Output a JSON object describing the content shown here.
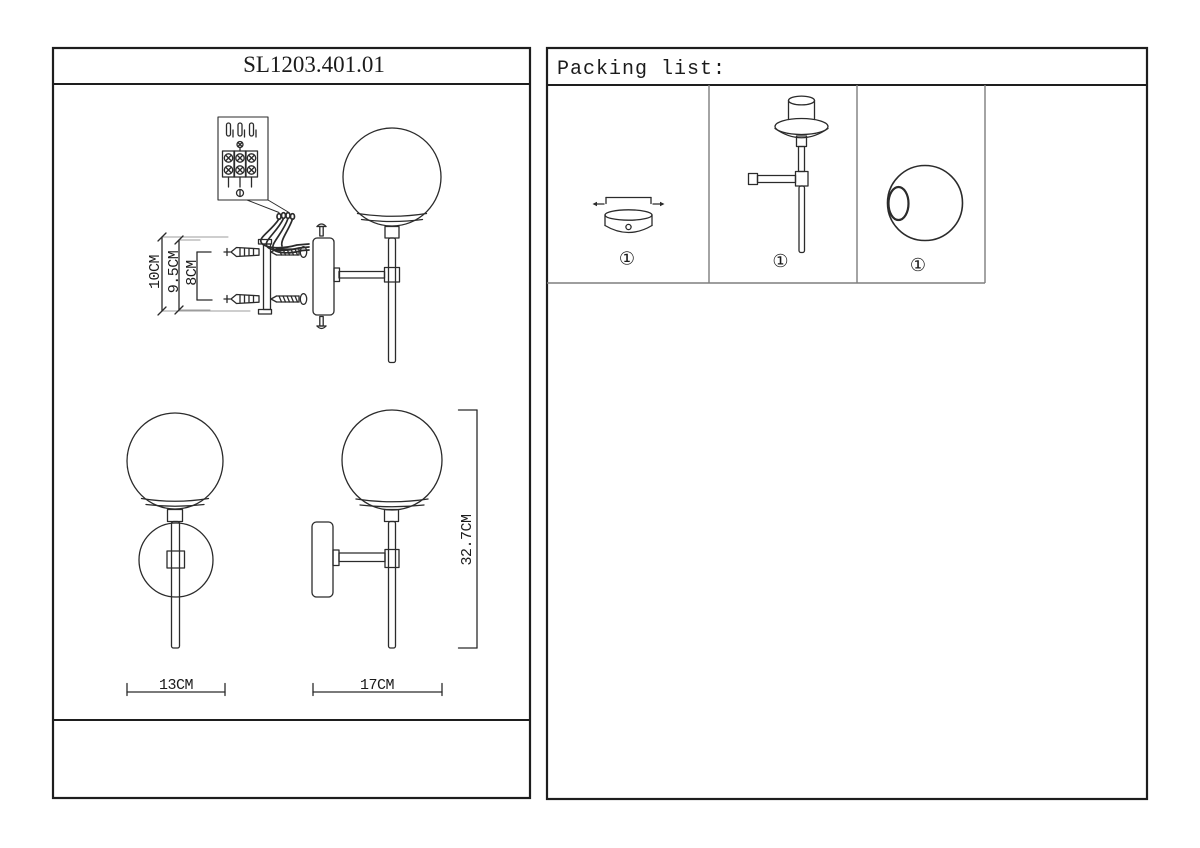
{
  "colors": {
    "background": "#ffffff",
    "ink": "#2b2b2b",
    "frame": "#1e1e1e",
    "grid_line": "#7e7e7e",
    "extension_line": "#9c9c9c"
  },
  "left_panel": {
    "title": "SL1203.401.01",
    "installation": {
      "dim_overall": "10CM",
      "dim_plate": "9.5CM",
      "dim_holes": "8CM"
    },
    "front_view": {
      "dim_width": "13CM"
    },
    "side_view": {
      "dim_depth": "17CM",
      "dim_height": "32.7CM"
    }
  },
  "right_panel": {
    "title": "Packing list:",
    "items": [
      {
        "name": "ceiling-canopy",
        "qty": "①"
      },
      {
        "name": "lamp-body",
        "qty": "①"
      },
      {
        "name": "glass-globe",
        "qty": "①"
      }
    ]
  }
}
